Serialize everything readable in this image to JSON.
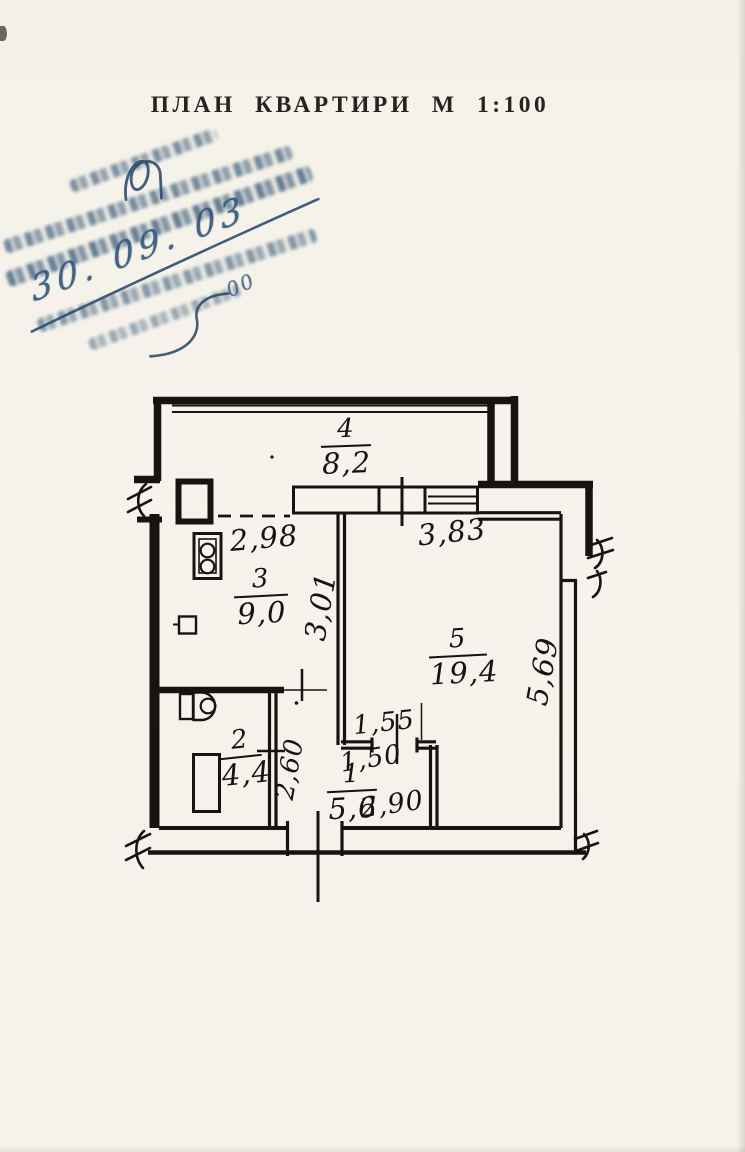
{
  "page": {
    "title": "ПЛАН КВАРТИРИ М 1:100"
  },
  "stamp": {
    "date": "30. 09. 03",
    "note": "00"
  },
  "plan": {
    "rooms": [
      {
        "number": "4",
        "area": "8,2"
      },
      {
        "number": "3",
        "area": "9,0"
      },
      {
        "number": "5",
        "area": "19,4"
      },
      {
        "number": "2",
        "area": "4,4"
      },
      {
        "number": "1",
        "area": "5,6"
      }
    ],
    "dimensions": {
      "kitchen_width": "2,98",
      "kitchen_depth": "3,01",
      "room5_width": "3,83",
      "room5_depth": "5,69",
      "hall_top": "1,55",
      "hall_door": "1,50",
      "hall_height": "2,60",
      "hall_width": "2,90"
    }
  }
}
